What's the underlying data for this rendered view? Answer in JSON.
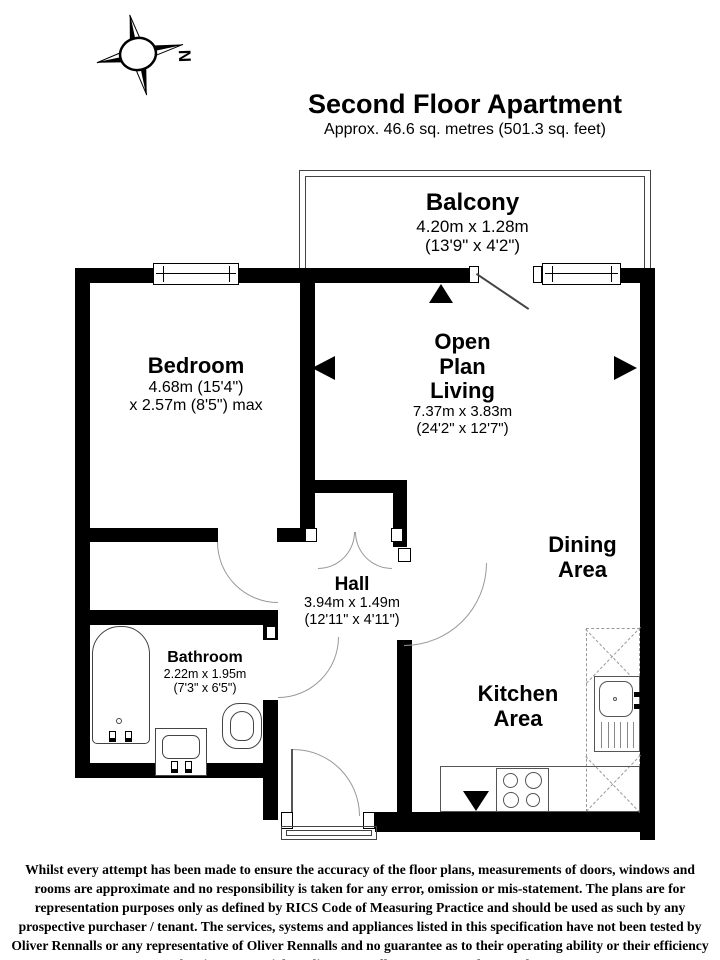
{
  "title": {
    "main": "Second Floor Apartment",
    "subtitle": "Approx. 46.6 sq. metres (501.3 sq. feet)"
  },
  "compass": {
    "north_label": "N"
  },
  "rooms": {
    "balcony": {
      "name": "Balcony",
      "dims_metric": "4.20m x 1.28m",
      "dims_imperial": "(13'9\" x 4'2\")"
    },
    "bedroom": {
      "name": "Bedroom",
      "dims_line1": "4.68m (15'4\")",
      "dims_line2": "x 2.57m (8'5\") max"
    },
    "living": {
      "name_line1": "Open",
      "name_line2": "Plan",
      "name_line3": "Living",
      "dims_metric": "7.37m x 3.83m",
      "dims_imperial": "(24'2\" x 12'7\")"
    },
    "dining": {
      "name_line1": "Dining",
      "name_line2": "Area"
    },
    "hall": {
      "name": "Hall",
      "dims_metric": "3.94m x 1.49m",
      "dims_imperial": "(12'11\" x 4'11\")"
    },
    "bathroom": {
      "name": "Bathroom",
      "dims_metric": "2.22m x 1.95m",
      "dims_imperial": "(7'3\" x 6'5\")"
    },
    "kitchen": {
      "name_line1": "Kitchen",
      "name_line2": "Area"
    }
  },
  "footer": {
    "disclaimer": "Whilst every attempt has been made to ensure the accuracy of the floor plans, measurements of doors, windows and rooms are approximate and no responsibility is taken for any error, omission or mis-statement. The plans are for representation purposes only as defined by RICS Code of Measuring Practice and should be used as such by any prospective purchaser / tenant. The services, systems and appliances listed in this specification have not been tested by Oliver Rennalls or any representative of Oliver Rennalls and no guarantee as to their operating ability or their efficiency can be given. Copyright: Oliver Rennalls Date Prepared – March 2025"
  },
  "colors": {
    "wall": "#000000",
    "fixture": "#444444",
    "arc": "#999999"
  }
}
